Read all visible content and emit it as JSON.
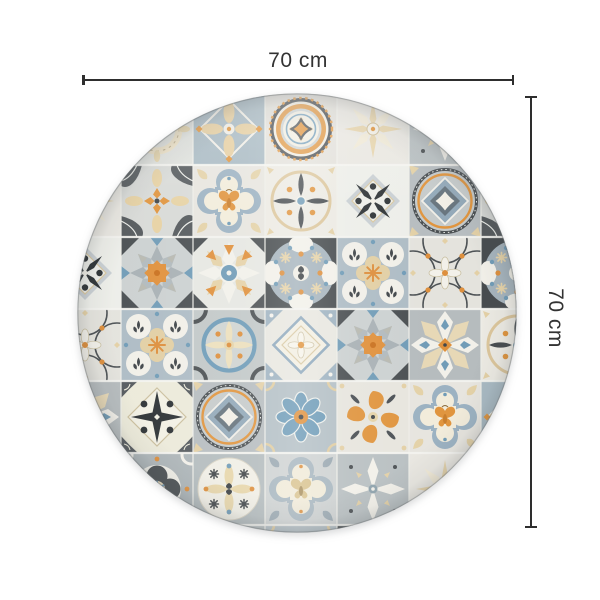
{
  "figure": {
    "title": "Round rug dimension diagram",
    "product": "Round vinyl mat with vintage azulejo patchwork tile pattern"
  },
  "dimensions": {
    "width_label": "70 cm",
    "height_label": "70 cm"
  },
  "annotation": {
    "line_color": "#2e2e2e",
    "text_color": "#333333"
  },
  "rug": {
    "shape": "circle",
    "diameter_px": 440,
    "tile_size": 72,
    "grid_offset": {
      "x": -28,
      "y": 0
    },
    "tile_grid": [
      [
        "white_petal",
        "wreath",
        "beige_cross",
        "medallion",
        "beige_star8",
        "white_petal",
        "ring_diamond"
      ],
      [
        "beige_star8",
        "orange_cross_fans",
        "quatrefoil_moth",
        "dark_leaf_cross",
        "black_star",
        "ring_diamond",
        "orange_cross_fans"
      ],
      [
        "black_star",
        "rosette_orange",
        "rosette_blue",
        "dark_circle_orb",
        "four_orbs",
        "arc_cross",
        "dark_circle_orb"
      ],
      [
        "arc_cross",
        "four_orbs",
        "blue_circle_petals",
        "diamond_flower",
        "rosette_orange",
        "star8_cream",
        "dark_leaf_cross"
      ],
      [
        "star8_cream",
        "north_star",
        "ring_diamond",
        "blue_flower",
        "orange_curl",
        "quatrefoil_moth",
        "beige_cross"
      ],
      [
        "blue_flower",
        "dark_quatrefoil",
        "cream_cross_circle",
        "quatrefoil_beige",
        "white_petal",
        "beige_star8",
        "four_orbs"
      ],
      [
        "wreath",
        "beige_star8",
        "cream_cross_circle",
        "blue_flower",
        "rosette_orange",
        "arc_cross",
        "black_star"
      ]
    ],
    "palette": {
      "orange": "#E0953F",
      "blue": "#719CB7",
      "dark_gray": "#42474A",
      "mid_gray": "#AEB6BA",
      "light_gray": "#D9DBD8",
      "blue_gray": "#9FB2C0",
      "beige": "#E5D2A8",
      "off_white": "#F2F0E8"
    }
  }
}
